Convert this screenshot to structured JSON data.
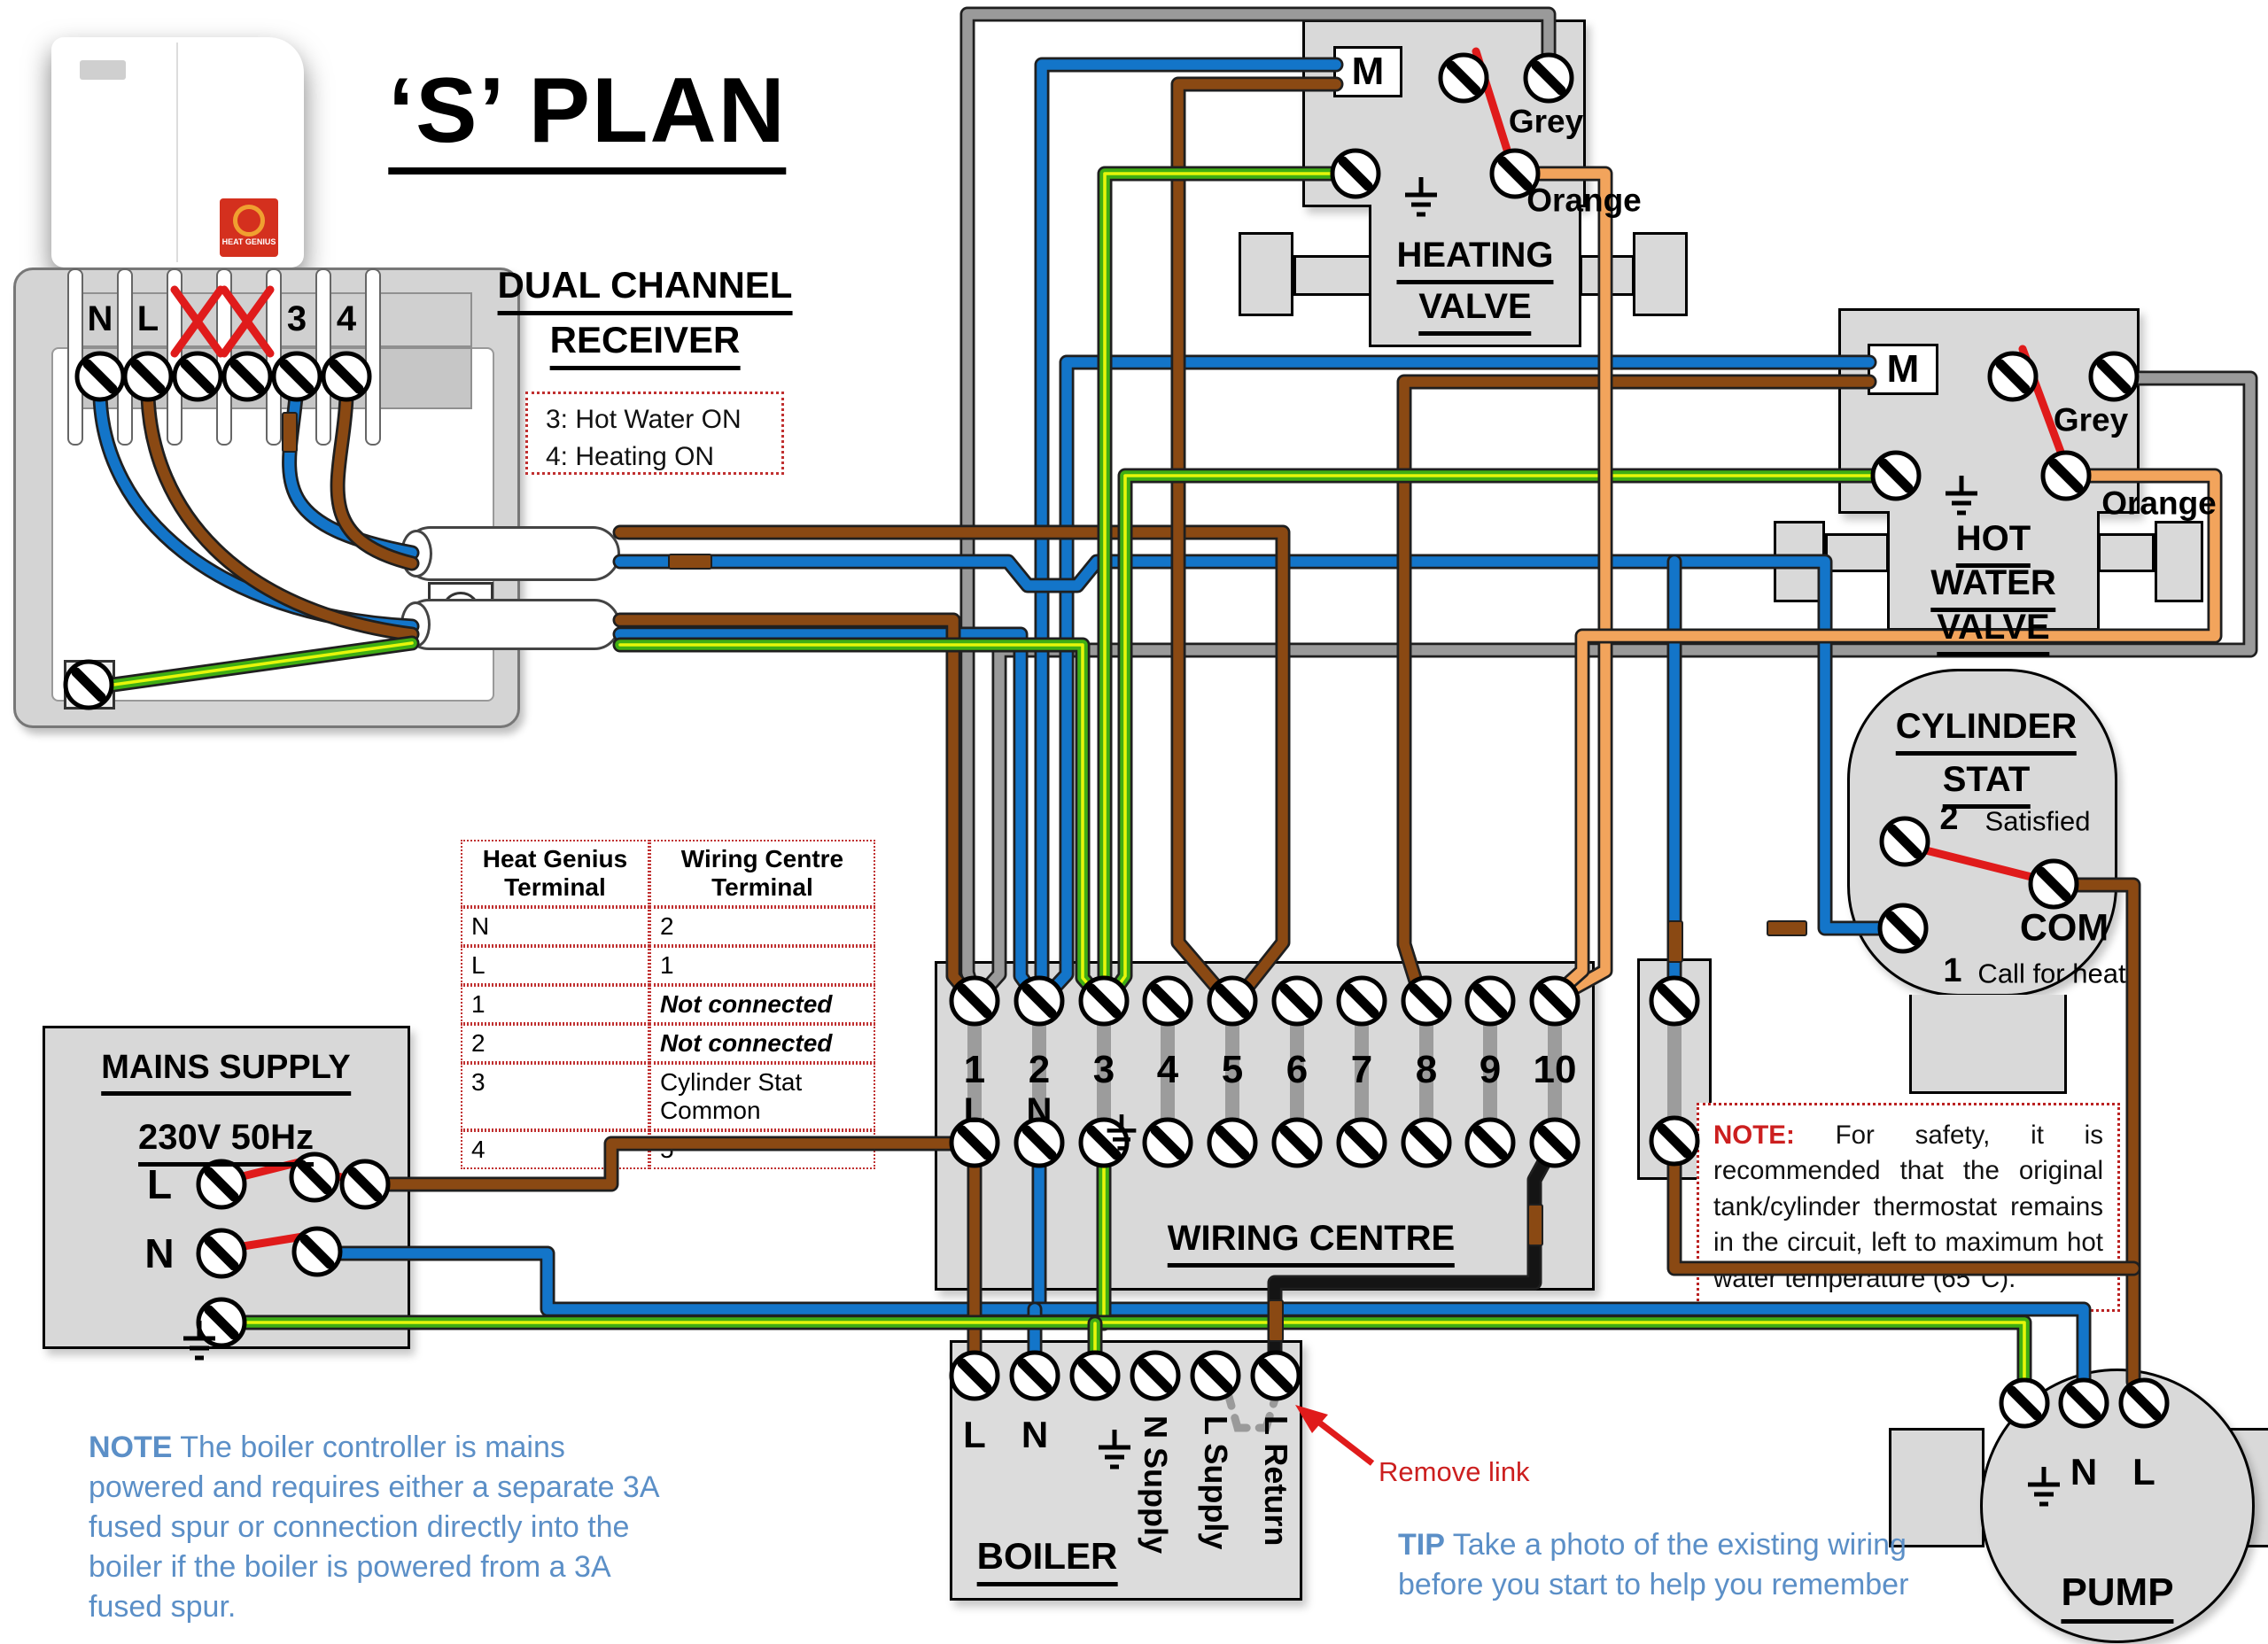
{
  "title": "‘S’ PLAN",
  "thermostat": {
    "logo_text": "HEAT GENIUS"
  },
  "receiver": {
    "title_lines": [
      "DUAL CHANNEL",
      "RECEIVER"
    ],
    "terminals": [
      "N",
      "L",
      "3",
      "4"
    ],
    "channel_note": [
      "3: Hot Water ON",
      "4: Heating ON"
    ]
  },
  "heating_valve": {
    "motor": "M",
    "grey_label": "Grey",
    "orange_label": "Orange",
    "name_lines": [
      "HEATING",
      "VALVE"
    ]
  },
  "hot_water_valve": {
    "motor": "M",
    "grey_label": "Grey",
    "orange_label": "Orange",
    "name_lines": [
      "HOT",
      "WATER",
      "VALVE"
    ]
  },
  "cylinder_stat": {
    "title_lines": [
      "CYLINDER",
      "STAT"
    ],
    "terminal_2": "2",
    "satisfied": "Satisfied",
    "com": "COM",
    "terminal_1": "1",
    "call_for_heat": "Call for heat"
  },
  "terminal_table": {
    "headers": [
      "Heat Genius Terminal",
      "Wiring Centre Terminal"
    ],
    "rows": [
      [
        "N",
        "2"
      ],
      [
        "L",
        "1"
      ],
      [
        "1",
        "Not connected"
      ],
      [
        "2",
        "Not connected"
      ],
      [
        "3",
        "Cylinder Stat Common"
      ],
      [
        "4",
        "5"
      ]
    ]
  },
  "mains_supply": {
    "title": "MAINS SUPPLY",
    "rating": "230V 50Hz",
    "live": "L",
    "neutral": "N"
  },
  "wiring_centre": {
    "title": "WIRING CENTRE",
    "terminals": [
      "1",
      "2",
      "3",
      "4",
      "5",
      "6",
      "7",
      "8",
      "9",
      "10"
    ],
    "live": "L",
    "neutral": "N"
  },
  "boiler": {
    "title": "BOILER",
    "live": "L",
    "neutral": "N",
    "n_supply": "N Supply",
    "l_supply": "L Supply",
    "l_return": "L Return",
    "remove_link": "Remove link"
  },
  "pump": {
    "title": "PUMP",
    "neutral": "N",
    "live": "L"
  },
  "notes": {
    "safety_label": "NOTE:",
    "safety_text": " For safety, it is recommended that the original tank/cylinder thermostat remains in the circuit, left to maximum hot water temperature (65°C).",
    "controller_label": "NOTE",
    "controller_text": " The boiler controller is mains powered and requires either a separate 3A fused spur or connection directly into the boiler if the boiler is powered from a 3A fused spur.",
    "tip_label": "TIP",
    "tip_text": " Take a photo of the existing wiring before you start to help you remember"
  },
  "wire_colors": {
    "live_brown": "#8a4913",
    "neutral_blue": "#1375c9",
    "earth_green": "#3fae14",
    "earth_stripe_yellow": "#e6f50a",
    "grey": "#919191",
    "orange": "#f2a45c",
    "switch_red": "#e01b1b",
    "black": "#141414"
  }
}
